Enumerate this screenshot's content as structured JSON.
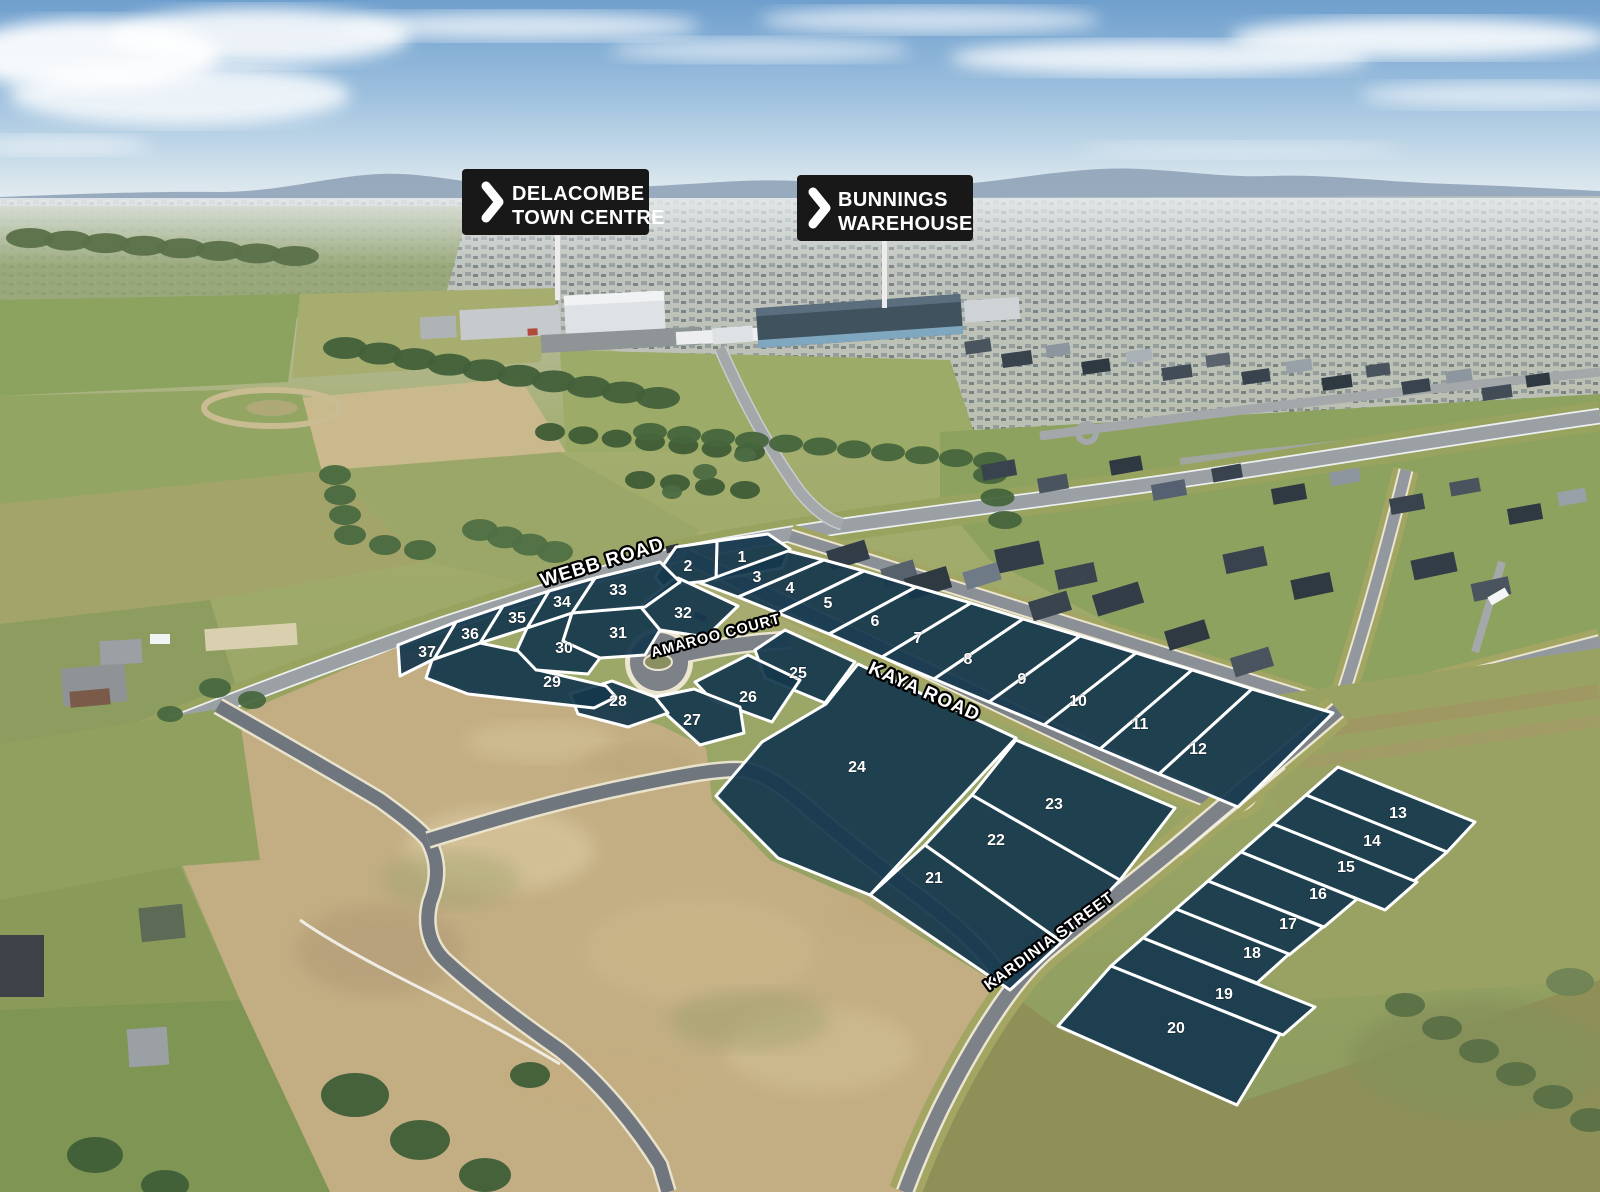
{
  "scene": {
    "description": "Aerial photograph of a residential land estate with numbered lot overlay"
  },
  "signs": [
    {
      "id": "delacombe-town-centre",
      "lines": [
        "DELACOMBE",
        "TOWN CENTRE"
      ]
    },
    {
      "id": "bunnings-warehouse",
      "lines": [
        "BUNNINGS",
        "WAREHOUSE"
      ]
    }
  ],
  "road_labels": [
    {
      "id": "webb-road",
      "text": "WEBB ROAD"
    },
    {
      "id": "amaroo-court",
      "text": "AMAROO COURT"
    },
    {
      "id": "kaya-road",
      "text": "KAYA ROAD"
    },
    {
      "id": "kardinia-street",
      "text": "KARDINIA STREET"
    }
  ],
  "colors": {
    "lot_fill": "#16384e",
    "lot_border": "#ffffff",
    "lot_number": "#ffffff",
    "sign_bg": "#181818",
    "sign_text": "#ffffff",
    "road_label_fill": "#ffffff",
    "road_label_outline": "#000000"
  },
  "lots": [
    {
      "num": "1",
      "label": [
        742,
        557
      ],
      "poly": "717,541 768,534 790,549 782,568 716,580"
    },
    {
      "num": "2",
      "label": [
        688,
        566
      ],
      "poly": "655,577 676,547 717,541 716,580 662,586"
    },
    {
      "num": "3",
      "label": [
        757,
        577
      ],
      "poly": "700,583 788,551 824,560 738,597"
    },
    {
      "num": "4",
      "label": [
        790,
        588
      ],
      "poly": "738,597 824,560 864,571 778,613"
    },
    {
      "num": "5",
      "label": [
        828,
        603
      ],
      "poly": "778,613 864,571 916,587 829,634"
    },
    {
      "num": "6",
      "label": [
        875,
        621
      ],
      "poly": "829,634 916,587 971,603 882,657"
    },
    {
      "num": "7",
      "label": [
        918,
        638
      ],
      "poly": "882,657 971,603 1023,619 934,679"
    },
    {
      "num": "8",
      "label": [
        968,
        659
      ],
      "poly": "934,679 1023,619 1080,636 989,702"
    },
    {
      "num": "9",
      "label": [
        1022,
        679
      ],
      "poly": "989,702 1080,636 1136,653 1044,725"
    },
    {
      "num": "10",
      "label": [
        1078,
        701
      ],
      "poly": "1044,725 1136,653 1192,670 1100,749"
    },
    {
      "num": "11",
      "label": [
        1140,
        724
      ],
      "poly": "1100,749 1192,670 1252,689 1159,774"
    },
    {
      "num": "12",
      "label": [
        1198,
        749
      ],
      "poly": "1159,774 1252,689 1333,713 1238,807"
    },
    {
      "num": "13",
      "label": [
        1398,
        813
      ],
      "poly": "1338,767 1475,822 1447,852 1306,795"
    },
    {
      "num": "14",
      "label": [
        1372,
        841
      ],
      "poly": "1306,795 1447,852 1414,881 1273,824"
    },
    {
      "num": "15",
      "label": [
        1346,
        867
      ],
      "poly": "1273,824 1417,882 1385,910 1241,852"
    },
    {
      "num": "16",
      "label": [
        1318,
        894
      ],
      "poly": "1241,852 1357,899 1324,927 1208,881"
    },
    {
      "num": "17",
      "label": [
        1288,
        924
      ],
      "poly": "1208,881 1323,927 1289,955 1176,909"
    },
    {
      "num": "18",
      "label": [
        1252,
        953
      ],
      "poly": "1176,909 1289,954 1257,983 1143,938"
    },
    {
      "num": "19",
      "label": [
        1224,
        994
      ],
      "poly": "1143,938 1315,1007 1283,1035 1111,966"
    },
    {
      "num": "20",
      "label": [
        1176,
        1028
      ],
      "poly": "1111,966 1280,1034 1237,1105 1058,1026"
    },
    {
      "num": "21",
      "label": [
        934,
        878
      ],
      "poly": "925,845 1062,942 1010,990 870,895"
    },
    {
      "num": "22",
      "label": [
        996,
        840
      ],
      "poly": "972,795 1120,880 1062,942 925,845"
    },
    {
      "num": "23",
      "label": [
        1054,
        804
      ],
      "poly": "1016,740 1175,808 1120,880 972,795"
    },
    {
      "num": "24",
      "label": [
        857,
        767
      ],
      "poly": "716,796 762,742 826,704 858,664 1016,738 870,895 778,858"
    },
    {
      "num": "25",
      "label": [
        798,
        673
      ],
      "poly": "755,650 785,630 855,662 825,703 765,678"
    },
    {
      "num": "26",
      "label": [
        748,
        697
      ],
      "poly": "695,682 748,655 800,680 772,722 712,700"
    },
    {
      "num": "27",
      "label": [
        692,
        720
      ],
      "poly": "655,697 694,689 740,707 744,733 700,745 666,714"
    },
    {
      "num": "28",
      "label": [
        618,
        701
      ],
      "poly": "570,694 612,681 655,697 668,713 628,727 578,714"
    },
    {
      "num": "29",
      "label": [
        552,
        682
      ],
      "poly": "432,660 480,643 518,651 538,670 606,686 616,697 594,708 468,694 426,678"
    },
    {
      "num": "30",
      "label": [
        564,
        648
      ],
      "poly": "527,628 572,613 563,641 600,658 588,674 536,670 517,650"
    },
    {
      "num": "31",
      "label": [
        618,
        633
      ],
      "poly": "572,613 640,606 660,630 645,655 600,658 563,641"
    },
    {
      "num": "32",
      "label": [
        683,
        613
      ],
      "poly": "640,606 672,580 678,578 738,606 706,637 660,630"
    },
    {
      "num": "33",
      "label": [
        618,
        590
      ],
      "poly": "595,578 660,562 680,582 645,607 572,613"
    },
    {
      "num": "34",
      "label": [
        562,
        602
      ],
      "poly": "549,591 595,578 572,613 527,628"
    },
    {
      "num": "35",
      "label": [
        517,
        618
      ],
      "poly": "503,606 549,591 527,628 480,643"
    },
    {
      "num": "36",
      "label": [
        470,
        634
      ],
      "poly": "456,622 503,606 480,643 434,659"
    },
    {
      "num": "37",
      "label": [
        427,
        652
      ],
      "poly": "398,645 456,622 434,659 400,676"
    }
  ]
}
